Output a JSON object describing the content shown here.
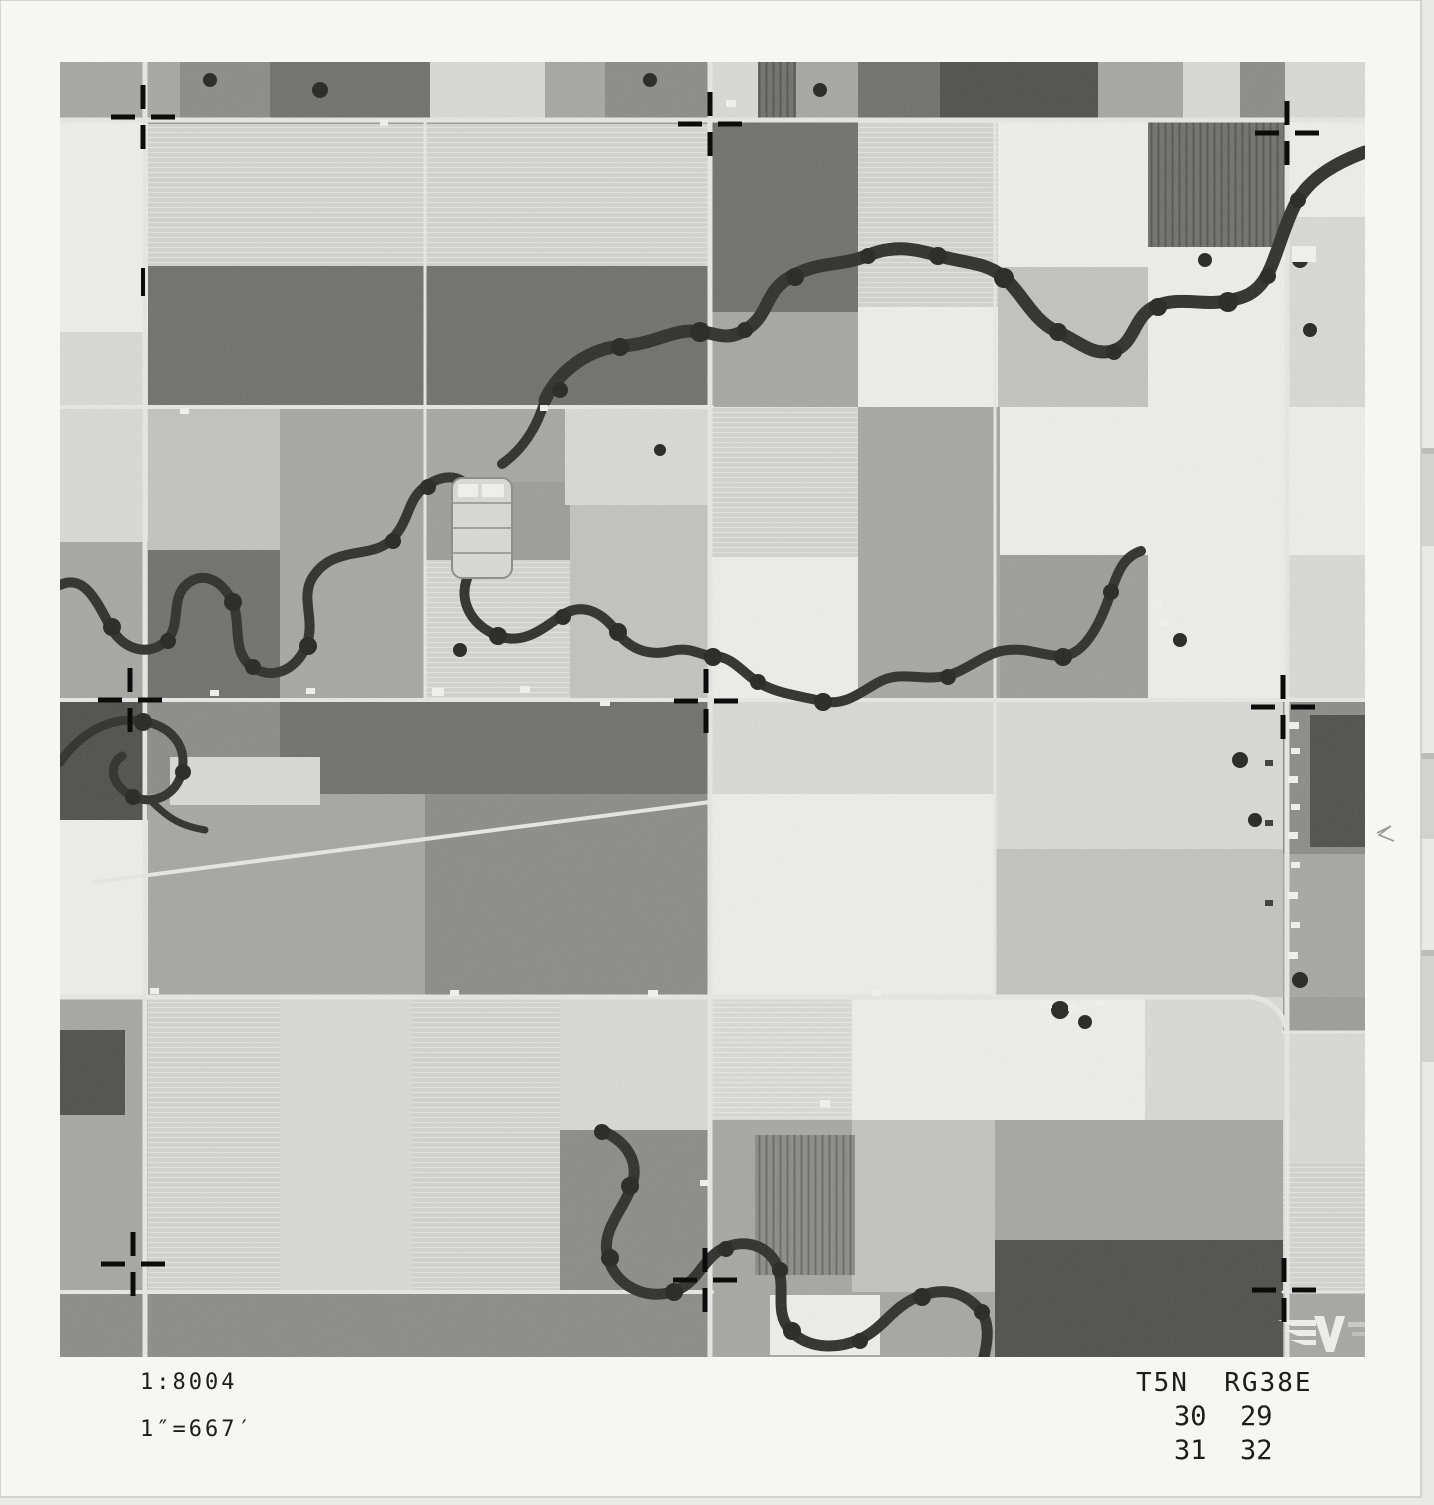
{
  "annotations": {
    "scale_ratio": "1:8004",
    "scale_equiv": "1″=667′",
    "township_range": "T5N  RG38E",
    "sections": {
      "nw": "30",
      "ne": "29",
      "sw": "31",
      "se": "32"
    }
  },
  "colors": {
    "scanner_bg": "#e9e9e7",
    "scanner_band": "#d2d2d0",
    "paper": "#f6f6f4",
    "paper_edge": "#c9c9c7",
    "road": "#e7e7e5",
    "river": "#2d2d2b",
    "tree": "#232321",
    "cross": "#0c0c0c",
    "building_light": "#f2f2f0",
    "building_dark": "#3a3a38",
    "pencil": "#9a9a98",
    "text": "#1c1c1c",
    "tones": {
      "base": "#9c9c9a",
      "w": "#eeeeec",
      "l": "#d9d9d7",
      "ls": "#d2d2d0",
      "lm": "#c2c2c0",
      "m": "#a6a6a4",
      "md": "#8b8b89",
      "d": "#6f6f6d",
      "dd": "#4e4e4c"
    }
  },
  "scanner": {
    "bands": [
      [
        448,
        98
      ],
      [
        753,
        86
      ],
      [
        950,
        112
      ]
    ]
  },
  "photo": {
    "paper": {
      "w": 1421,
      "h": 1497
    },
    "content": {
      "x": 60,
      "y": 62,
      "w": 1305,
      "h": 1295
    },
    "fields": [
      [
        60,
        62,
        120,
        58,
        "m"
      ],
      [
        180,
        62,
        90,
        58,
        "md"
      ],
      [
        270,
        62,
        160,
        58,
        "d"
      ],
      [
        430,
        62,
        115,
        58,
        "l"
      ],
      [
        545,
        62,
        60,
        58,
        "m"
      ],
      [
        605,
        62,
        105,
        58,
        "md"
      ],
      [
        710,
        62,
        48,
        58,
        "l"
      ],
      [
        758,
        62,
        38,
        58,
        "d",
        "vs"
      ],
      [
        796,
        62,
        62,
        58,
        "m"
      ],
      [
        858,
        62,
        82,
        58,
        "d"
      ],
      [
        940,
        62,
        158,
        58,
        "dd"
      ],
      [
        1098,
        62,
        85,
        58,
        "m"
      ],
      [
        1183,
        62,
        57,
        58,
        "l"
      ],
      [
        1240,
        62,
        45,
        58,
        "md"
      ],
      [
        1285,
        62,
        80,
        58,
        "l"
      ],
      [
        60,
        122,
        88,
        210,
        "w"
      ],
      [
        60,
        332,
        88,
        75,
        "l"
      ],
      [
        148,
        124,
        277,
        142,
        "ls",
        "hs"
      ],
      [
        425,
        124,
        285,
        142,
        "ls",
        "hs"
      ],
      [
        148,
        266,
        277,
        141,
        "d"
      ],
      [
        425,
        266,
        285,
        141,
        "d"
      ],
      [
        712,
        122,
        146,
        190,
        "d"
      ],
      [
        858,
        122,
        140,
        185,
        "ls",
        "hs"
      ],
      [
        998,
        122,
        150,
        145,
        "w"
      ],
      [
        1148,
        122,
        137,
        125,
        "d",
        "vs"
      ],
      [
        1285,
        122,
        80,
        95,
        "w"
      ],
      [
        712,
        312,
        146,
        95,
        "m"
      ],
      [
        858,
        307,
        140,
        100,
        "w"
      ],
      [
        998,
        267,
        150,
        140,
        "lm"
      ],
      [
        1148,
        247,
        137,
        160,
        "w"
      ],
      [
        1285,
        217,
        80,
        190,
        "l"
      ],
      [
        60,
        407,
        88,
        135,
        "l"
      ],
      [
        60,
        542,
        88,
        158,
        "m"
      ],
      [
        148,
        407,
        132,
        143,
        "lm"
      ],
      [
        280,
        407,
        145,
        143,
        "m"
      ],
      [
        148,
        550,
        132,
        150,
        "d"
      ],
      [
        280,
        550,
        145,
        150,
        "m"
      ],
      [
        425,
        407,
        140,
        75,
        "m"
      ],
      [
        565,
        407,
        145,
        98,
        "l"
      ],
      [
        425,
        560,
        145,
        140,
        "ls",
        "hs"
      ],
      [
        570,
        505,
        142,
        195,
        "lm"
      ],
      [
        712,
        407,
        146,
        150,
        "ls",
        "hs"
      ],
      [
        858,
        407,
        142,
        148,
        "m"
      ],
      [
        1000,
        407,
        148,
        148,
        "w"
      ],
      [
        1148,
        407,
        137,
        293,
        "w"
      ],
      [
        1285,
        407,
        80,
        148,
        "w"
      ],
      [
        1285,
        555,
        80,
        145,
        "l"
      ],
      [
        712,
        557,
        146,
        143,
        "w"
      ],
      [
        858,
        555,
        142,
        145,
        "m"
      ],
      [
        60,
        700,
        88,
        120,
        "dd"
      ],
      [
        60,
        820,
        88,
        177,
        "w"
      ],
      [
        148,
        702,
        132,
        92,
        "md"
      ],
      [
        280,
        702,
        145,
        92,
        "d"
      ],
      [
        425,
        702,
        285,
        92,
        "d"
      ],
      [
        148,
        794,
        277,
        203,
        "m"
      ],
      [
        170,
        757,
        150,
        48,
        "l"
      ],
      [
        425,
        794,
        285,
        203,
        "md"
      ],
      [
        712,
        702,
        283,
        92,
        "l"
      ],
      [
        712,
        794,
        283,
        203,
        "w"
      ],
      [
        995,
        702,
        288,
        147,
        "l"
      ],
      [
        995,
        849,
        288,
        148,
        "lm"
      ],
      [
        1283,
        702,
        82,
        152,
        "md"
      ],
      [
        1310,
        715,
        55,
        132,
        "dd"
      ],
      [
        1283,
        854,
        82,
        143,
        "m"
      ],
      [
        60,
        997,
        88,
        295,
        "m"
      ],
      [
        60,
        1030,
        65,
        85,
        "dd"
      ],
      [
        148,
        997,
        132,
        295,
        "ls",
        "hs"
      ],
      [
        280,
        997,
        132,
        295,
        "l"
      ],
      [
        412,
        997,
        148,
        295,
        "ls",
        "hs"
      ],
      [
        560,
        997,
        152,
        133,
        "l"
      ],
      [
        560,
        1130,
        152,
        162,
        "md"
      ],
      [
        712,
        997,
        140,
        123,
        "l",
        "hs"
      ],
      [
        852,
        997,
        143,
        123,
        "w"
      ],
      [
        712,
        1120,
        140,
        172,
        "m"
      ],
      [
        852,
        1120,
        143,
        172,
        "lm"
      ],
      [
        755,
        1135,
        100,
        140,
        "md",
        "vs"
      ],
      [
        995,
        997,
        150,
        123,
        "w"
      ],
      [
        1145,
        997,
        138,
        123,
        "l"
      ],
      [
        995,
        1120,
        288,
        120,
        "m"
      ],
      [
        1283,
        1032,
        82,
        130,
        "l"
      ],
      [
        1283,
        1162,
        82,
        130,
        "ls",
        "hs"
      ],
      [
        995,
        1240,
        288,
        117,
        "dd"
      ],
      [
        60,
        1292,
        650,
        65,
        "md"
      ],
      [
        712,
        1292,
        283,
        65,
        "m"
      ],
      [
        770,
        1295,
        110,
        60,
        "w"
      ],
      [
        1283,
        1292,
        82,
        65,
        "m"
      ]
    ],
    "roads": [
      [
        60,
        120,
        1365,
        120,
        5
      ],
      [
        60,
        407,
        712,
        407,
        4
      ],
      [
        60,
        700,
        1365,
        700,
        4
      ],
      [
        60,
        997,
        1252,
        997,
        5
      ],
      [
        60,
        1292,
        712,
        1292,
        4
      ],
      [
        1283,
        1292,
        1365,
        1292,
        3
      ],
      [
        145,
        62,
        145,
        1357,
        5
      ],
      [
        425,
        120,
        425,
        700,
        3
      ],
      [
        710,
        62,
        710,
        1357,
        5
      ],
      [
        995,
        120,
        995,
        997,
        3
      ],
      [
        1287,
        120,
        1287,
        1357,
        5
      ],
      [
        95,
        882,
        710,
        802,
        4
      ],
      [
        1283,
        1032,
        1365,
        1032,
        3
      ]
    ],
    "road_paths": [
      [
        "M1252,997 C1270,1000 1284,1012 1287,1032",
        5
      ]
    ],
    "rivers": [
      [
        "M545,400 C560,368 592,348 622,346 C652,344 668,332 690,331 C712,330 722,342 742,332 C772,316 762,292 792,276 C820,261 842,266 866,256 C892,245 912,248 936,255 C962,263 986,262 1002,276 C1022,292 1032,320 1056,331 C1080,342 1092,356 1112,351 C1136,345 1132,316 1156,306 C1180,296 1202,306 1226,301 C1244,298 1256,294 1266,277 C1276,260 1284,225 1296,203 C1310,177 1338,162 1365,152",
        13
      ],
      [
        "M545,400 C537,428 522,450 502,464",
        10
      ],
      [
        "M60,585 C84,574 96,600 110,626 C124,652 150,656 166,641 C182,626 170,600 186,585 C202,570 222,580 232,601 C242,622 231,651 251,666 C271,681 296,671 306,646 C316,621 301,601 311,580 C331,544 371,560 391,540 C411,520 406,500 426,486 C446,472 462,476 472,491",
        10
      ],
      [
        "M470,572 C456,598 470,624 496,635 C522,646 541,630 561,616 C581,602 601,611 616,631 C631,651 651,656 671,651 C691,646 701,656 712,656 C732,656 741,671 756,681 C776,694 801,696 821,701 C846,707 861,691 881,681 C901,671 921,681 946,676 C966,671 981,656 1001,651 C1026,646 1041,656 1061,656 C1085,656 1101,622 1111,592 C1119,567 1126,556 1141,551",
        10
      ],
      [
        "M60,762 C82,731 112,716 142,721 C172,726 187,746 182,771 C177,796 152,806 132,796 C112,786 107,766 122,756",
        9
      ],
      [
        "M150,800 C170,820 182,826 205,830",
        7
      ],
      [
        "M600,1130 C625,1140 640,1160 632,1185 C624,1210 600,1230 608,1258 C616,1286 645,1300 672,1292 C699,1284 702,1258 724,1248 C746,1238 770,1246 778,1268 C786,1290 774,1312 790,1330 C806,1348 834,1350 858,1340 C884,1329 892,1306 920,1296 C948,1286 966,1294 980,1310 C990,1322 988,1340 984,1357",
        11
      ]
    ],
    "trees": [
      [
        700,
        332,
        10
      ],
      [
        745,
        330,
        8
      ],
      [
        795,
        277,
        9
      ],
      [
        868,
        256,
        8
      ],
      [
        938,
        256,
        9
      ],
      [
        1004,
        278,
        10
      ],
      [
        1058,
        332,
        9
      ],
      [
        1114,
        352,
        8
      ],
      [
        1158,
        307,
        9
      ],
      [
        1228,
        302,
        10
      ],
      [
        1268,
        276,
        8
      ],
      [
        1298,
        200,
        8
      ],
      [
        620,
        347,
        9
      ],
      [
        560,
        390,
        8
      ],
      [
        112,
        627,
        9
      ],
      [
        168,
        641,
        8
      ],
      [
        233,
        602,
        9
      ],
      [
        253,
        667,
        8
      ],
      [
        308,
        646,
        9
      ],
      [
        393,
        541,
        8
      ],
      [
        428,
        487,
        8
      ],
      [
        498,
        636,
        9
      ],
      [
        563,
        617,
        8
      ],
      [
        618,
        632,
        9
      ],
      [
        713,
        657,
        9
      ],
      [
        758,
        682,
        8
      ],
      [
        823,
        702,
        9
      ],
      [
        948,
        677,
        8
      ],
      [
        1063,
        657,
        9
      ],
      [
        1111,
        592,
        8
      ],
      [
        143,
        722,
        9
      ],
      [
        183,
        772,
        8
      ],
      [
        133,
        797,
        8
      ],
      [
        602,
        1132,
        8
      ],
      [
        630,
        1186,
        9
      ],
      [
        610,
        1258,
        9
      ],
      [
        674,
        1292,
        9
      ],
      [
        726,
        1249,
        8
      ],
      [
        780,
        1270,
        8
      ],
      [
        792,
        1331,
        9
      ],
      [
        860,
        1341,
        8
      ],
      [
        922,
        1297,
        9
      ],
      [
        982,
        1312,
        8
      ],
      [
        210,
        80,
        7
      ],
      [
        320,
        90,
        8
      ],
      [
        650,
        80,
        7
      ],
      [
        820,
        90,
        7
      ],
      [
        1205,
        260,
        7
      ],
      [
        1300,
        260,
        8
      ],
      [
        1310,
        330,
        7
      ],
      [
        460,
        650,
        7
      ],
      [
        660,
        450,
        6
      ],
      [
        1180,
        640,
        7
      ],
      [
        1240,
        760,
        8
      ],
      [
        1255,
        820,
        7
      ],
      [
        1300,
        980,
        8
      ],
      [
        1060,
        1010,
        9
      ],
      [
        1085,
        1022,
        7
      ]
    ],
    "buildings": [
      [
        1289,
        722,
        10,
        7,
        "w"
      ],
      [
        1291,
        748,
        9,
        6,
        "w"
      ],
      [
        1288,
        776,
        10,
        7,
        "w"
      ],
      [
        1291,
        804,
        9,
        6,
        "w"
      ],
      [
        1288,
        832,
        10,
        7,
        "w"
      ],
      [
        1291,
        862,
        9,
        6,
        "w"
      ],
      [
        1288,
        892,
        10,
        7,
        "w"
      ],
      [
        1291,
        922,
        9,
        6,
        "w"
      ],
      [
        1288,
        952,
        10,
        7,
        "w"
      ],
      [
        1265,
        760,
        8,
        6,
        "d"
      ],
      [
        1265,
        820,
        8,
        6,
        "d"
      ],
      [
        1265,
        900,
        8,
        6,
        "d"
      ],
      [
        1292,
        246,
        24,
        16,
        "w"
      ],
      [
        432,
        688,
        12,
        8,
        "w"
      ],
      [
        520,
        686,
        10,
        7,
        "w"
      ],
      [
        726,
        100,
        10,
        7,
        "w"
      ],
      [
        1040,
        1000,
        12,
        8,
        "w"
      ],
      [
        1068,
        1004,
        10,
        7,
        "w"
      ],
      [
        1096,
        1000,
        9,
        6,
        "w"
      ],
      [
        306,
        688,
        9,
        6,
        "w"
      ],
      [
        210,
        690,
        9,
        6,
        "w"
      ],
      [
        648,
        990,
        10,
        7,
        "w"
      ],
      [
        872,
        990,
        9,
        6,
        "w"
      ],
      [
        450,
        990,
        9,
        6,
        "w"
      ],
      [
        150,
        988,
        9,
        6,
        "w"
      ],
      [
        180,
        408,
        9,
        6,
        "w"
      ],
      [
        600,
        700,
        10,
        6,
        "w"
      ],
      [
        1152,
        600,
        10,
        7,
        "w"
      ],
      [
        1160,
        620,
        8,
        6,
        "w"
      ],
      [
        380,
        120,
        8,
        6,
        "w"
      ],
      [
        540,
        405,
        8,
        6,
        "w"
      ],
      [
        820,
        1100,
        10,
        7,
        "w"
      ],
      [
        700,
        1180,
        9,
        6,
        "w"
      ]
    ],
    "feedlot": {
      "x": 452,
      "y": 478,
      "w": 60,
      "h": 100
    },
    "crosses": [
      [
        143,
        117
      ],
      [
        710,
        124
      ],
      [
        1287,
        133
      ],
      [
        130,
        700
      ],
      [
        706,
        701
      ],
      [
        1283,
        707
      ],
      [
        133,
        1264
      ],
      [
        705,
        1280
      ],
      [
        1284,
        1290
      ]
    ],
    "ticks": [
      [
        143,
        282,
        "v"
      ]
    ],
    "logo": {
      "name": "winged-v-watermark",
      "x": 1278,
      "y": 1316
    },
    "pencil_mark": {
      "points": "1377,833 1391,826 1379,835 1394,841"
    }
  }
}
